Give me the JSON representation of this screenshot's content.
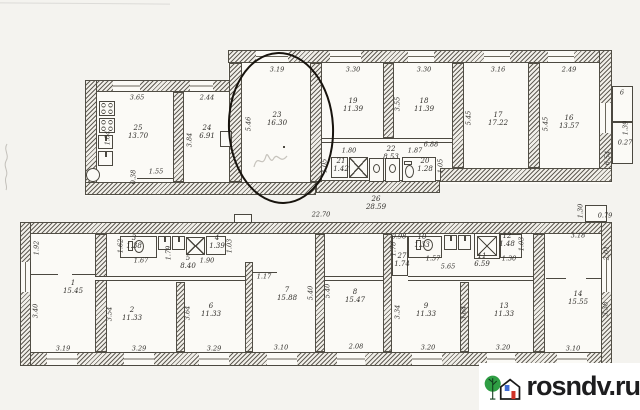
{
  "document_type": "scanned floor plan (two building levels) with one room circled",
  "watermark": {
    "site": "rosndv.ru",
    "tree_color": "#2f9e44",
    "branch_color": "#123d1e",
    "house_color": "#1a1a1a",
    "window_color": "#3f6cd6",
    "door_color": "#cf3227",
    "text_color": "#1d1d1f"
  },
  "annotation": {
    "shape": "hand-drawn ellipse",
    "highlights_room": "23"
  },
  "upper_plan": {
    "rooms": [
      {
        "num": "25",
        "area": "13.70",
        "x": 138,
        "y": 133
      },
      {
        "num": "24",
        "area": "6.91",
        "x": 207,
        "y": 133
      },
      {
        "num": "23",
        "area": "16.30",
        "x": 277,
        "y": 120
      },
      {
        "num": "19",
        "area": "11.39",
        "x": 353,
        "y": 106
      },
      {
        "num": "18",
        "area": "11.39",
        "x": 424,
        "y": 106
      },
      {
        "num": "17",
        "area": "17.22",
        "x": 498,
        "y": 120
      },
      {
        "num": "16",
        "area": "13.57",
        "x": 569,
        "y": 123
      },
      {
        "num": "21",
        "area": "1.42",
        "x": 341,
        "y": 166
      },
      {
        "num": "22",
        "area": "8.53",
        "x": 391,
        "y": 154
      },
      {
        "num": "20",
        "area": "1.28",
        "x": 425,
        "y": 166
      }
    ],
    "dims": [
      {
        "t": "3.65",
        "x": 137,
        "y": 98
      },
      {
        "t": "2.44",
        "x": 207,
        "y": 98
      },
      {
        "t": "3.19",
        "x": 277,
        "y": 70
      },
      {
        "t": "3.30",
        "x": 353,
        "y": 70
      },
      {
        "t": "3.30",
        "x": 424,
        "y": 70
      },
      {
        "t": "3.16",
        "x": 498,
        "y": 70
      },
      {
        "t": "2.49",
        "x": 569,
        "y": 70
      },
      {
        "t": "5.46",
        "x": 249,
        "y": 124,
        "r": 1
      },
      {
        "t": "3.84",
        "x": 190,
        "y": 140,
        "r": 1
      },
      {
        "t": "3.55",
        "x": 398,
        "y": 104,
        "r": 1
      },
      {
        "t": "5.45",
        "x": 469,
        "y": 118,
        "r": 1
      },
      {
        "t": "5.45",
        "x": 546,
        "y": 124,
        "r": 1
      },
      {
        "t": "6.88",
        "x": 431,
        "y": 145
      },
      {
        "t": "1.80",
        "x": 349,
        "y": 151
      },
      {
        "t": "1.87",
        "x": 415,
        "y": 151
      },
      {
        "t": "1.05",
        "x": 325,
        "y": 166,
        "r": 1
      },
      {
        "t": "1.05",
        "x": 441,
        "y": 166,
        "r": 1
      },
      {
        "t": "1.55",
        "x": 156,
        "y": 172
      },
      {
        "t": "0.38",
        "x": 134,
        "y": 177,
        "r": 1
      },
      {
        "t": "1.04",
        "x": 108,
        "y": 138,
        "r": 1
      },
      {
        "t": "6",
        "x": 622,
        "y": 93
      },
      {
        "t": "1.39",
        "x": 626,
        "y": 128,
        "r": 1
      },
      {
        "t": "0.27",
        "x": 625,
        "y": 143
      },
      {
        "t": "6.54",
        "x": 608,
        "y": 158,
        "r": 1
      }
    ]
  },
  "lower_plan": {
    "rooms": [
      {
        "num": "1",
        "area": "15.45",
        "x": 73,
        "y": 288
      },
      {
        "num": "2",
        "area": "11.33",
        "x": 132,
        "y": 315
      },
      {
        "num": "6",
        "area": "11.33",
        "x": 211,
        "y": 311
      },
      {
        "num": "7",
        "area": "15.88",
        "x": 287,
        "y": 295
      },
      {
        "num": "8",
        "area": "15.47",
        "x": 355,
        "y": 297
      },
      {
        "num": "9",
        "area": "11.33",
        "x": 426,
        "y": 311
      },
      {
        "num": "13",
        "area": "11.33",
        "x": 504,
        "y": 311
      },
      {
        "num": "14",
        "area": "15.55",
        "x": 578,
        "y": 299
      },
      {
        "num": "3",
        "area": "1.38",
        "x": 134,
        "y": 243
      },
      {
        "num": "4",
        "area": "1.39",
        "x": 217,
        "y": 243
      },
      {
        "num": "5",
        "area": "8.40",
        "x": 188,
        "y": 263
      },
      {
        "num": "10",
        "area": "1.33",
        "x": 422,
        "y": 242
      },
      {
        "num": "11",
        "area": "6.59",
        "x": 482,
        "y": 261
      },
      {
        "num": "12",
        "area": "1.48",
        "x": 507,
        "y": 241
      },
      {
        "num": "27",
        "area": "1.74",
        "x": 402,
        "y": 261
      },
      {
        "num": "26",
        "area": "28.59",
        "x": 376,
        "y": 204
      }
    ],
    "dims": [
      {
        "t": "22.70",
        "x": 321,
        "y": 215
      },
      {
        "t": "1.30",
        "x": 581,
        "y": 211,
        "r": 1
      },
      {
        "t": "0.79",
        "x": 605,
        "y": 216
      },
      {
        "t": "1.92",
        "x": 37,
        "y": 248,
        "r": 1
      },
      {
        "t": "3.40",
        "x": 36,
        "y": 311,
        "r": 1
      },
      {
        "t": "3.19",
        "x": 63,
        "y": 349
      },
      {
        "t": "3.54",
        "x": 110,
        "y": 314,
        "r": 1
      },
      {
        "t": "3.29",
        "x": 139,
        "y": 349
      },
      {
        "t": "3.64",
        "x": 188,
        "y": 313,
        "r": 1
      },
      {
        "t": "3.29",
        "x": 214,
        "y": 349
      },
      {
        "t": "1.17",
        "x": 264,
        "y": 277
      },
      {
        "t": "3.10",
        "x": 281,
        "y": 348
      },
      {
        "t": "5.40",
        "x": 311,
        "y": 293,
        "r": 1
      },
      {
        "t": "5.40",
        "x": 328,
        "y": 291,
        "r": 1
      },
      {
        "t": "2.08",
        "x": 356,
        "y": 347
      },
      {
        "t": "3.34",
        "x": 398,
        "y": 312,
        "r": 1
      },
      {
        "t": "3.20",
        "x": 428,
        "y": 348
      },
      {
        "t": "3.64",
        "x": 464,
        "y": 313,
        "r": 1
      },
      {
        "t": "3.20",
        "x": 503,
        "y": 348
      },
      {
        "t": "3.18",
        "x": 578,
        "y": 236
      },
      {
        "t": "2.01",
        "x": 607,
        "y": 253,
        "r": 1
      },
      {
        "t": "3.38",
        "x": 606,
        "y": 309,
        "r": 1
      },
      {
        "t": "3.10",
        "x": 573,
        "y": 349
      },
      {
        "t": "1.62",
        "x": 121,
        "y": 246,
        "r": 1
      },
      {
        "t": "1.67",
        "x": 141,
        "y": 261
      },
      {
        "t": "1.79",
        "x": 169,
        "y": 253,
        "r": 1
      },
      {
        "t": "1.90",
        "x": 207,
        "y": 261
      },
      {
        "t": "1.03",
        "x": 230,
        "y": 246,
        "r": 1
      },
      {
        "t": "0.98",
        "x": 399,
        "y": 237
      },
      {
        "t": "1.78",
        "x": 394,
        "y": 249,
        "r": 1
      },
      {
        "t": "1.57",
        "x": 433,
        "y": 259
      },
      {
        "t": "5.65",
        "x": 448,
        "y": 267
      },
      {
        "t": "1.30",
        "x": 509,
        "y": 259
      },
      {
        "t": "1.03",
        "x": 522,
        "y": 244,
        "r": 1
      }
    ]
  }
}
